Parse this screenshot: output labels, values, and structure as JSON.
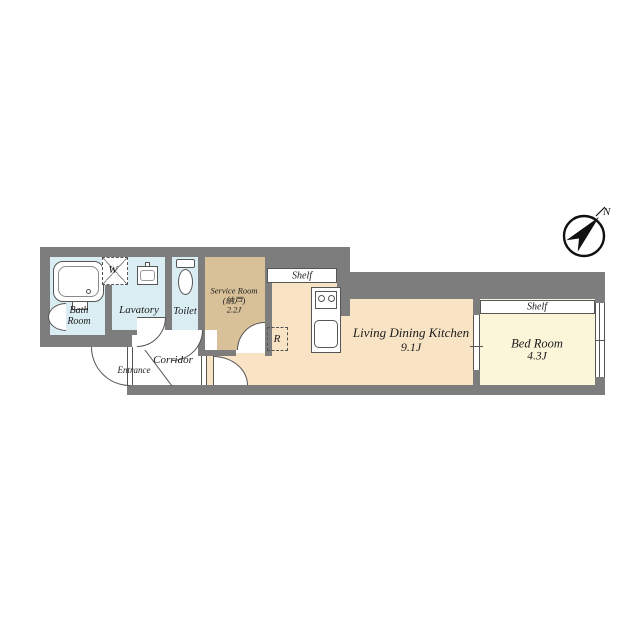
{
  "compass": {
    "north_label": "N"
  },
  "rooms": {
    "bath": {
      "line1": "Bath",
      "line2": "Room"
    },
    "lavatory": {
      "label": "Lavatory"
    },
    "toilet": {
      "label": "Toilet"
    },
    "service": {
      "line1": "Service Room",
      "line2": "(納戸)",
      "line3": "2.2J"
    },
    "corridor": {
      "label": "Corridor"
    },
    "entrance": {
      "label": "Entrance"
    },
    "ldk": {
      "line1": "Living Dining Kitchen",
      "line2": "9.1J"
    },
    "bedroom": {
      "line1": "Bed Room",
      "line2": "4.3J"
    }
  },
  "fixtures": {
    "washer_label": "W",
    "refrigerator_label": "R",
    "kitchen_shelf_label": "Shelf",
    "bedroom_shelf_label": "Shelf"
  },
  "colors": {
    "wall": "#7d7d7d",
    "outline": "#555555",
    "wet_room_floor": "#d9edf3",
    "service_room_floor": "#d8c099",
    "ldk_floor": "#f9e3c5",
    "bedroom_floor": "#fbf5d9",
    "text": "#1b1b1b"
  }
}
